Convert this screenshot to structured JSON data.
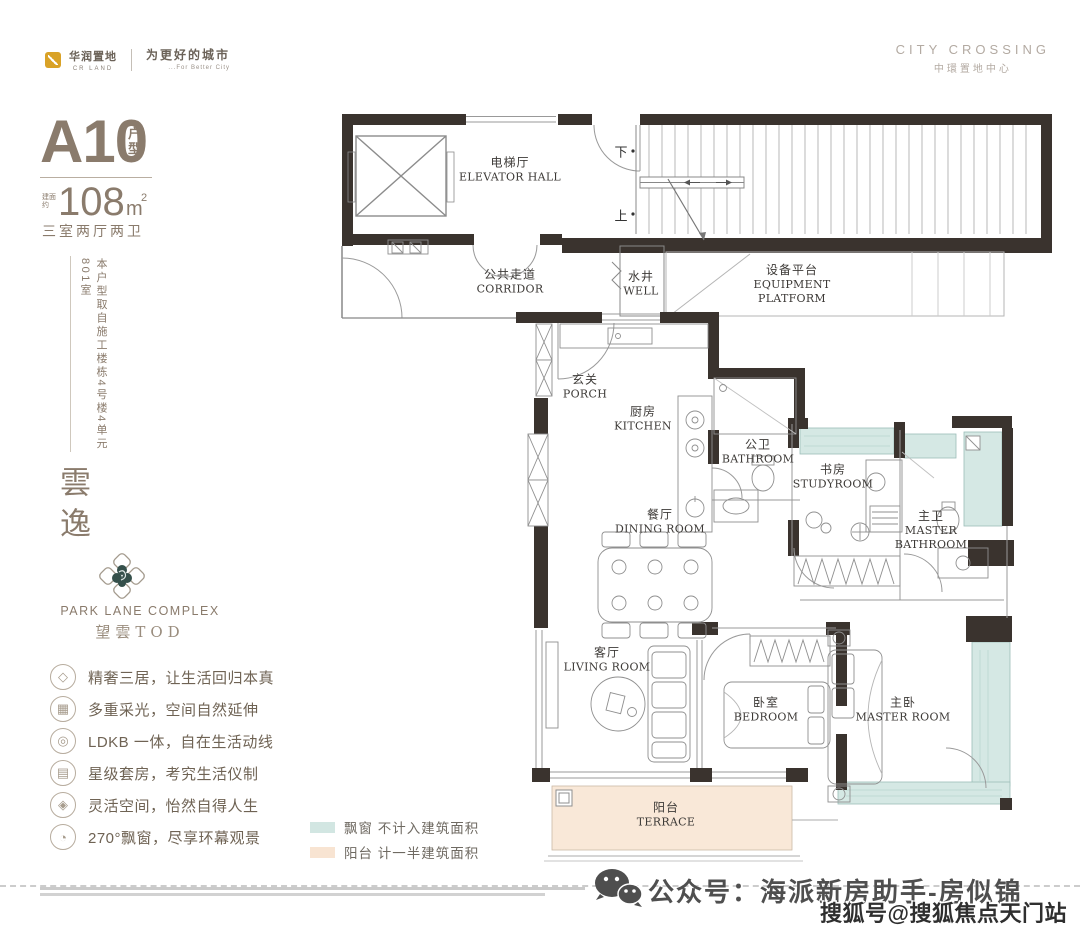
{
  "header": {
    "brand": {
      "name_cn": "华润置地",
      "name_en": "CR LAND",
      "slogan_cn": "为更好的城市",
      "slogan_en": "...For Better City",
      "logo_color": "#d9a227"
    },
    "project": {
      "name_en": "CITY CROSSING",
      "name_cn": "中環置地中心"
    }
  },
  "unit": {
    "model": "A10",
    "model_suffix": "户型",
    "area_prefix": "建面约",
    "area_value": "108",
    "area_unit": "m",
    "area_exponent": "2",
    "rooms_summary": "三室两厅两卫",
    "source_note": "本户型取自施工楼栋4号楼4单元801室"
  },
  "branding": {
    "name_vertical": "雲逸",
    "complex_name_en": "PARK LANE COMPLEX",
    "complex_name_cn": "望雲TOD"
  },
  "features": [
    {
      "icon": "diamond-icon",
      "glyph": "◇",
      "text": "精奢三居，让生活回归本真"
    },
    {
      "icon": "daylight-icon",
      "glyph": "▦",
      "text": "多重采光，空间自然延伸"
    },
    {
      "icon": "dining-flow-icon",
      "glyph": "◎",
      "text": "LDKB 一体，自在生活动线"
    },
    {
      "icon": "suite-icon",
      "glyph": "▤",
      "text": "星级套房，考究生活仪制"
    },
    {
      "icon": "flex-space-icon",
      "glyph": "◈",
      "text": "灵活空间，怡然自得人生"
    },
    {
      "icon": "bay-window-icon",
      "glyph": "◔",
      "text": "270°飘窗，尽享环幕观景"
    }
  ],
  "legend": [
    {
      "name": "bay-window",
      "color": "#d2e6e2",
      "label": "飘窗 不计入建筑面积"
    },
    {
      "name": "balcony",
      "color": "#f8e4d2",
      "label": "阳台 计一半建筑面积"
    }
  ],
  "floorplan": {
    "stair_down": "下",
    "stair_up": "上",
    "rooms": [
      {
        "cn": "电梯厅",
        "en": "ELEVATOR HALL"
      },
      {
        "cn": "公共走道",
        "en": "CORRIDOR"
      },
      {
        "cn": "水井",
        "en": "WELL"
      },
      {
        "cn": "设备平台",
        "en": "EQUIPMENT PLATFORM"
      },
      {
        "cn": "玄关",
        "en": "PORCH"
      },
      {
        "cn": "厨房",
        "en": "KITCHEN"
      },
      {
        "cn": "公卫",
        "en": "BATHROOM"
      },
      {
        "cn": "书房",
        "en": "STUDYROOM"
      },
      {
        "cn": "主卫",
        "en": "MASTER BATHROOM"
      },
      {
        "cn": "餐厅",
        "en": "DINING ROOM"
      },
      {
        "cn": "客厅",
        "en": "LIVING ROOM"
      },
      {
        "cn": "卧室",
        "en": "BEDROOM"
      },
      {
        "cn": "主卧",
        "en": "MASTER ROOM"
      },
      {
        "cn": "阳台",
        "en": "TERRACE"
      }
    ]
  },
  "footer": {
    "wechat_label": "公众号：海派新房助手-房似锦",
    "watermark": "搜狐号@搜狐焦点天门站"
  },
  "colors": {
    "accent_taupe": "#8a7b6c",
    "wall_dark": "#3a332e",
    "bay_window_fill": "#d5e8e4",
    "balcony_fill": "#f9e8d8"
  }
}
